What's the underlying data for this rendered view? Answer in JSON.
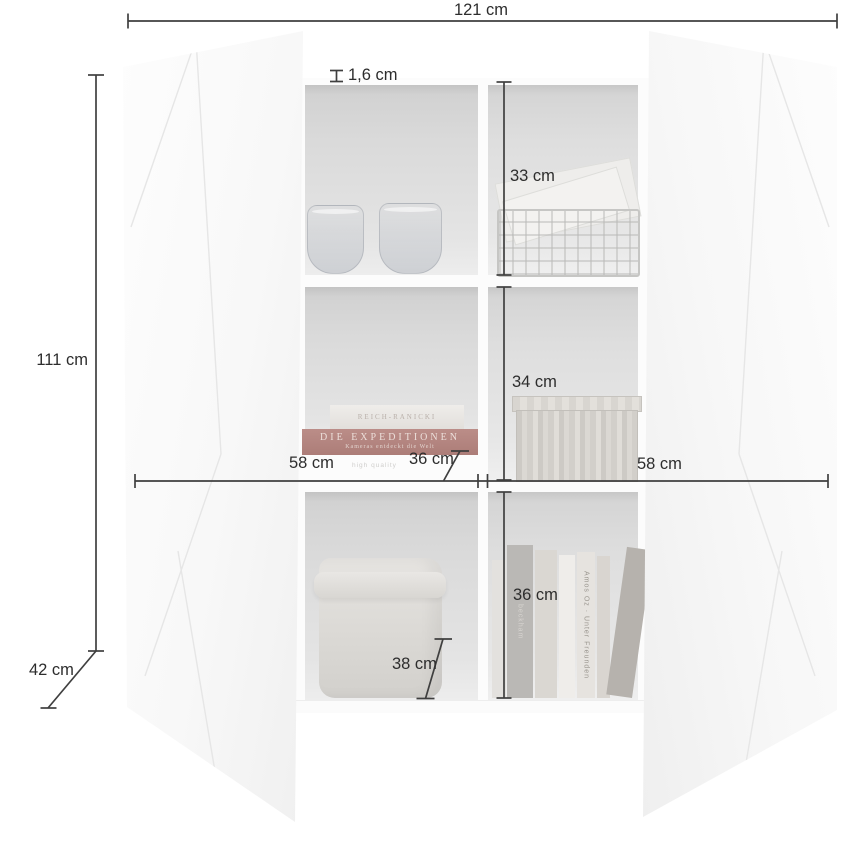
{
  "annotations": {
    "total_width": "121 cm",
    "total_height": "111 cm",
    "total_depth": "42 cm",
    "panel_thickness": "1,6 cm",
    "compartment_heights": [
      "33 cm",
      "34 cm",
      "36 cm"
    ],
    "inner_width_left": "58 cm",
    "shelf_depth_middle": "36 cm",
    "inner_width_right": "58 cm",
    "shelf_depth_bottom": "38 cm"
  },
  "decor": {
    "shelf_print": "high quality",
    "stacked_book_top": "REICH-RANICKI",
    "stacked_book_bottom": "DIE EXPEDITIONEN",
    "stacked_book_subtitle": "Kameras entdeckt die Welt",
    "spine_gray_book": "beckham",
    "spine_white_book": "Amos Oz · Unter Freunden"
  },
  "colors": {
    "dimension_line": "#3f3f3f",
    "label_text": "#2d2d2d",
    "compartment_gray": "#dedede",
    "door_white": "#fafafa",
    "accent_book_red": "#b3837e"
  }
}
